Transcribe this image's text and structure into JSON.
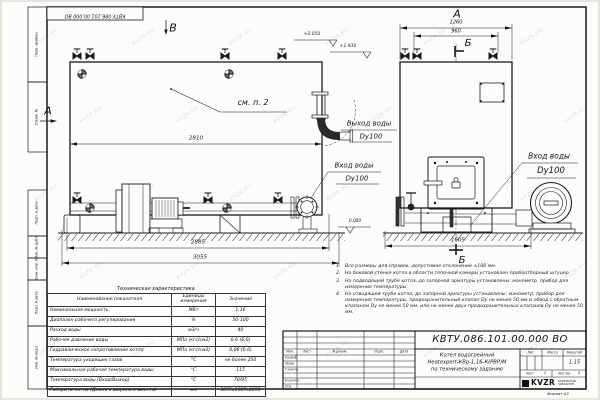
{
  "watermark": "KVZR.RU",
  "doc_number_top": "КВТУ.086.101.00.000 ВО",
  "format_label": "Формат А3",
  "margin_labels": [
    "Перв. примен.",
    "Справ. №",
    "Подп. и дата",
    "Инв. № дубл.",
    "Взам. инв. №",
    "Подп. и дата",
    "Инв. № подл."
  ],
  "views": {
    "front_mark": "В",
    "left_mark": "А",
    "side_mark": "А",
    "section_top": "Б",
    "section_bottom": "Б",
    "callout": "см. п. 2"
  },
  "elevations": {
    "e1": "+2.050",
    "e2": "+1.930",
    "e3": "0.000"
  },
  "dims": {
    "d2810": "2810",
    "d2885": "2885",
    "d3055": "3055",
    "d1260": "1260",
    "d960": "960",
    "d1605": "1605"
  },
  "labels": {
    "outlet1": "Выход воды",
    "outlet2": "Dy100",
    "inlet_front1": "Вход воды",
    "inlet_front2": "Dy100",
    "inlet_side1": "Вход воды",
    "inlet_side2": "Dy100"
  },
  "notes": [
    {
      "num": "1.",
      "text": "Все размеры для справок, допустимое отклонение ±100 мм."
    },
    {
      "num": "2.",
      "text": "На боковой стенке котла в области топочной камеры установлен пробоотборный штуцер"
    },
    {
      "num": "3.",
      "text": "На подводящей трубе котла, до запорной арматуры установлены: манометр, прибор для измерения температуры."
    },
    {
      "num": "4.",
      "text": "На отводящей трубе котла, до запорной арматуры установлены: манометр, прибор для измерения температуры, предохранительный клапан Dу не менее 50 мм и обвод с обратным клапаном Dу не менее 50 мм, или не менее двух предохранительных клапанов Dу не менее 50 мм."
    }
  ],
  "tech_table": {
    "title": "Техническая характеристика",
    "headers": [
      "Наименование показателя",
      "Единицы измерения",
      "Значение"
    ],
    "rows": [
      [
        "Номинальная мощность",
        "МВт",
        "1,16"
      ],
      [
        "Диапазон рабочего регулирования",
        "%",
        "50-100"
      ],
      [
        "Расход воды",
        "м3/ч",
        "40"
      ],
      [
        "Рабочее давление воды",
        "МПа (кгс/см2)",
        "0,6 (6,0)"
      ],
      [
        "Гидравлическое сопротивление котла",
        "МПа (кгс/см2)",
        "0,06 (0,6)"
      ],
      [
        "Температура уходящих газов",
        "°С",
        "не более 250"
      ],
      [
        "Максимальная рабочая температура воды",
        "°С",
        "115"
      ],
      [
        "Температура воды (Вход/Выход)",
        "°С",
        "70/95"
      ],
      [
        "Габариты котла (Длина х ширина х высота)",
        "мм",
        "3055х1605х2050"
      ]
    ]
  },
  "title_block": {
    "doc_number": "КВТУ.086.101.00.000 ВО",
    "name_line1": "Котел водогрейный",
    "name_line2": "Heatexpert-КВр-1,16-К(РВР)М",
    "name_line3": "по техническому заданию",
    "cols": [
      "Изм.",
      "Лист",
      "N докум.",
      "Подп.",
      "Дата"
    ],
    "rows": [
      "Разраб.",
      "Пров.",
      "Т.контр.",
      "Н.контр.",
      "Утв."
    ],
    "lit_label": "Лит.",
    "mass_label": "Масса",
    "scale_label": "Масштаб",
    "scale_value": "1:15",
    "sheet_label": "Лист",
    "sheet_value": "1",
    "sheets_label": "Листов",
    "sheets_value": "2",
    "logo_text": "KVZR",
    "org_line1": "КОТЕЛЬНЫЙ",
    "org_line2": "ЗАВОД РЭП"
  }
}
